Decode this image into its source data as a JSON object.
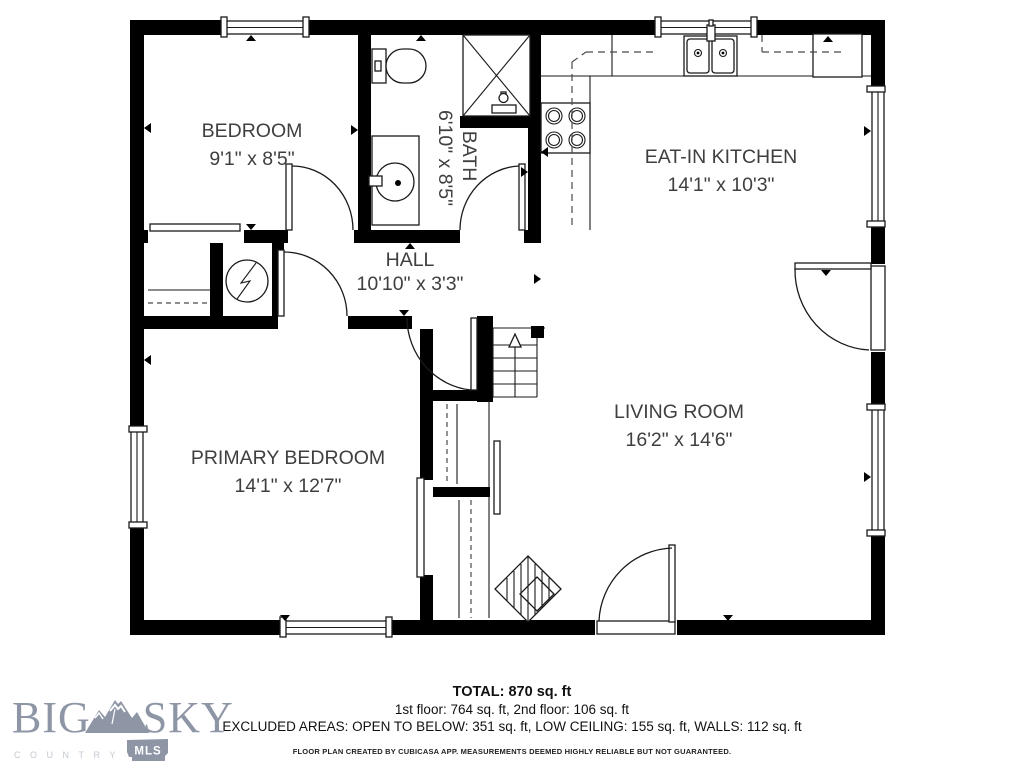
{
  "rooms": {
    "bedroom": {
      "name": "BEDROOM",
      "dims": "9'1\" x 8'5\""
    },
    "bath": {
      "name": "BATH",
      "dims": "6'10\" x 8'5\""
    },
    "kitchen": {
      "name": "EAT-IN KITCHEN",
      "dims": "14'1\" x 10'3\""
    },
    "hall": {
      "name": "HALL",
      "dims": "10'10\" x 3'3\""
    },
    "primary_bedroom": {
      "name": "PRIMARY BEDROOM",
      "dims": "14'1\" x 12'7\""
    },
    "living_room": {
      "name": "LIVING ROOM",
      "dims": "16'2\" x 14'6\""
    }
  },
  "summary": {
    "total": "TOTAL: 870 sq. ft",
    "floors": "1st floor: 764 sq. ft, 2nd floor: 106 sq. ft",
    "excluded": "EXCLUDED AREAS: OPEN TO BELOW: 351 sq. ft, LOW CEILING: 155 sq. ft, WALLS: 112 sq. ft",
    "disclaimer": "FLOOR PLAN CREATED BY CUBICASA APP. MEASUREMENTS DEEMED HIGHLY RELIABLE BUT NOT GUARANTEED."
  },
  "logo": {
    "word1": "BIG",
    "word2": "SKY",
    "sub": "COUNTRY",
    "badge": "MLS"
  },
  "colors": {
    "wall": "#000000",
    "line": "#1a1a1a",
    "label_text": "#3f3f3f",
    "logo": "#8e96a6",
    "logo_sub": "#c3c9d1"
  }
}
